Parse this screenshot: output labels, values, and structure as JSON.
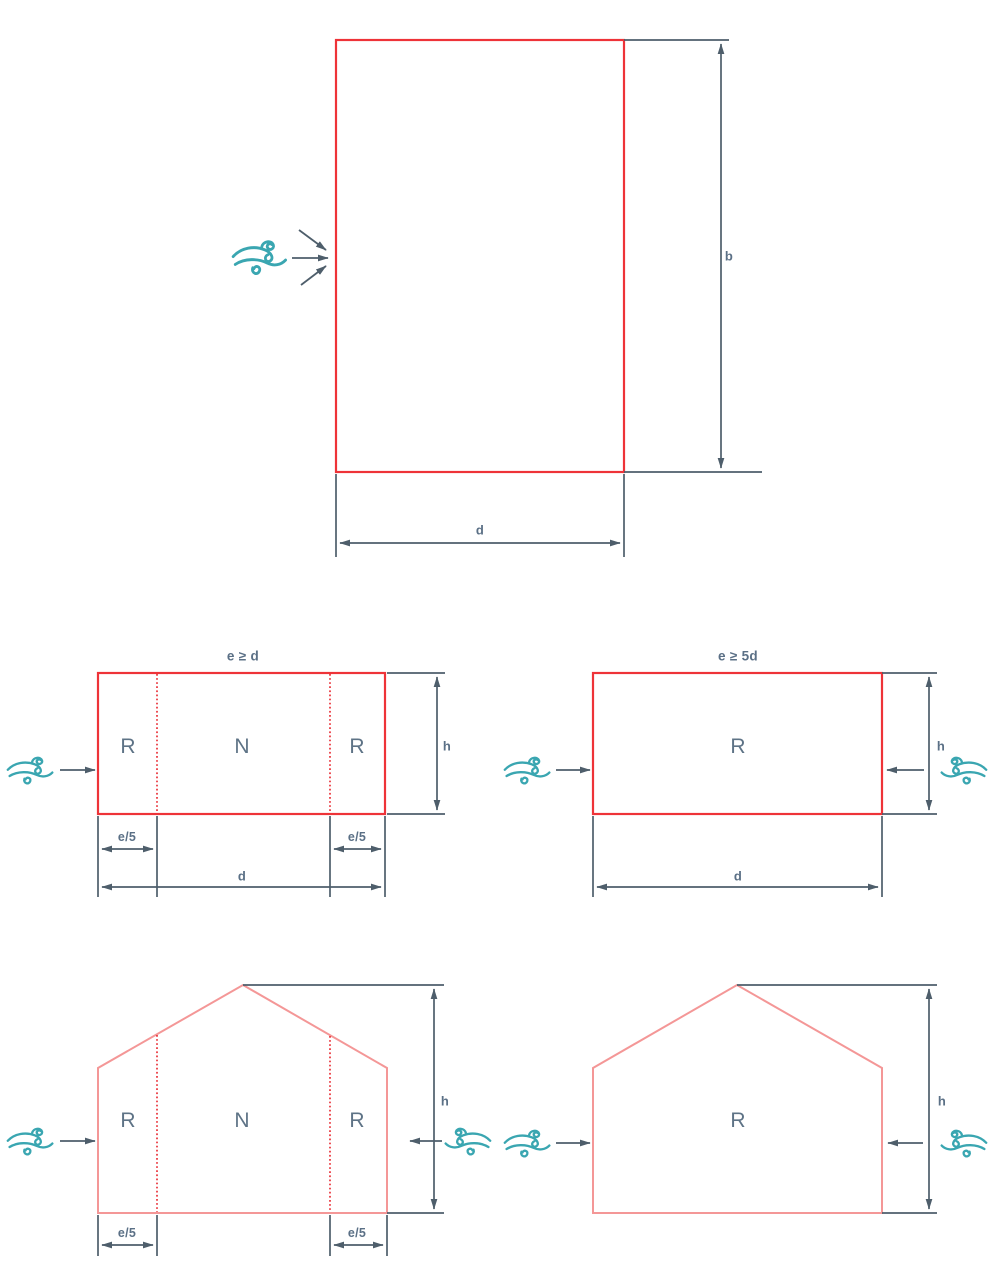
{
  "figure": "wind-zones-building-elevations",
  "colors": {
    "outline_red": "#ee3338",
    "outline_salmon": "#f49797",
    "dashed_red": "#e8232b",
    "dimension_slate": "#4e5e6b",
    "label_slate_blue": "#5b7086",
    "wind_teal": "#3aa6b1"
  },
  "top_plan": {
    "dim_b": "b",
    "dim_d": "d"
  },
  "mid_left": {
    "title": "e ≥ d",
    "zone_left": "R",
    "zone_mid": "N",
    "zone_right": "R",
    "dim_h": "h",
    "dim_e5_left": "e/5",
    "dim_e5_right": "e/5",
    "dim_d": "d"
  },
  "mid_right": {
    "title": "e ≥ 5d",
    "zone": "R",
    "dim_h": "h",
    "dim_d": "d"
  },
  "bottom_left": {
    "zone_left": "R",
    "zone_mid": "N",
    "zone_right": "R",
    "dim_h": "h",
    "dim_e5_left": "e/5",
    "dim_e5_right": "e/5"
  },
  "bottom_right": {
    "zone": "R",
    "dim_h": "h"
  }
}
